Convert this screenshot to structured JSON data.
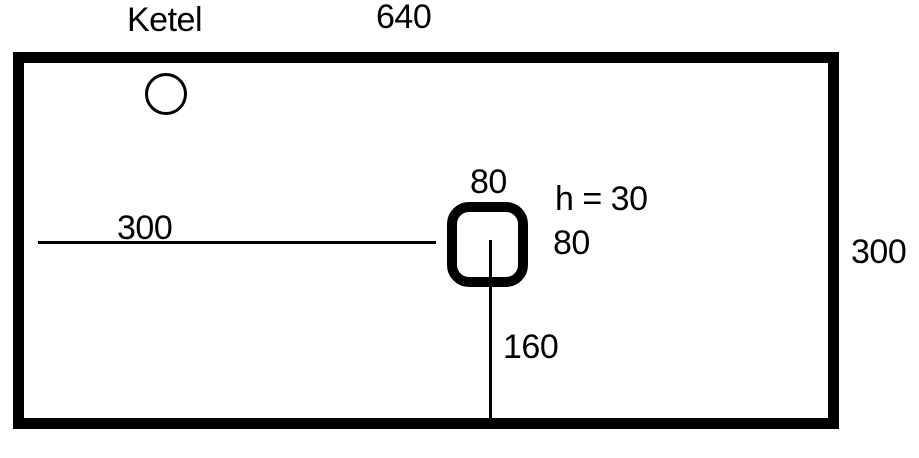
{
  "diagram": {
    "title": "Ketel",
    "shapes": {
      "vessel": "rectangle 640 x 300 with thick border",
      "burner": "small circle near top-left",
      "hole": "rounded square 80 x 80, h = 30"
    },
    "labels": {
      "top_width": "640",
      "left_offset": "300",
      "right_height": "300",
      "hole_width": "80",
      "hole_height": "80",
      "hole_note": "h = 30",
      "bottom_offset": "160"
    },
    "dimensions": {
      "vessel_width": 640,
      "vessel_height": 300,
      "hole_width": 80,
      "hole_height": 80,
      "hole_h": 30,
      "hole_from_left": 300,
      "hole_from_bottom": 160
    },
    "colors": {
      "ink": "#000000",
      "background": "#ffffff"
    }
  }
}
